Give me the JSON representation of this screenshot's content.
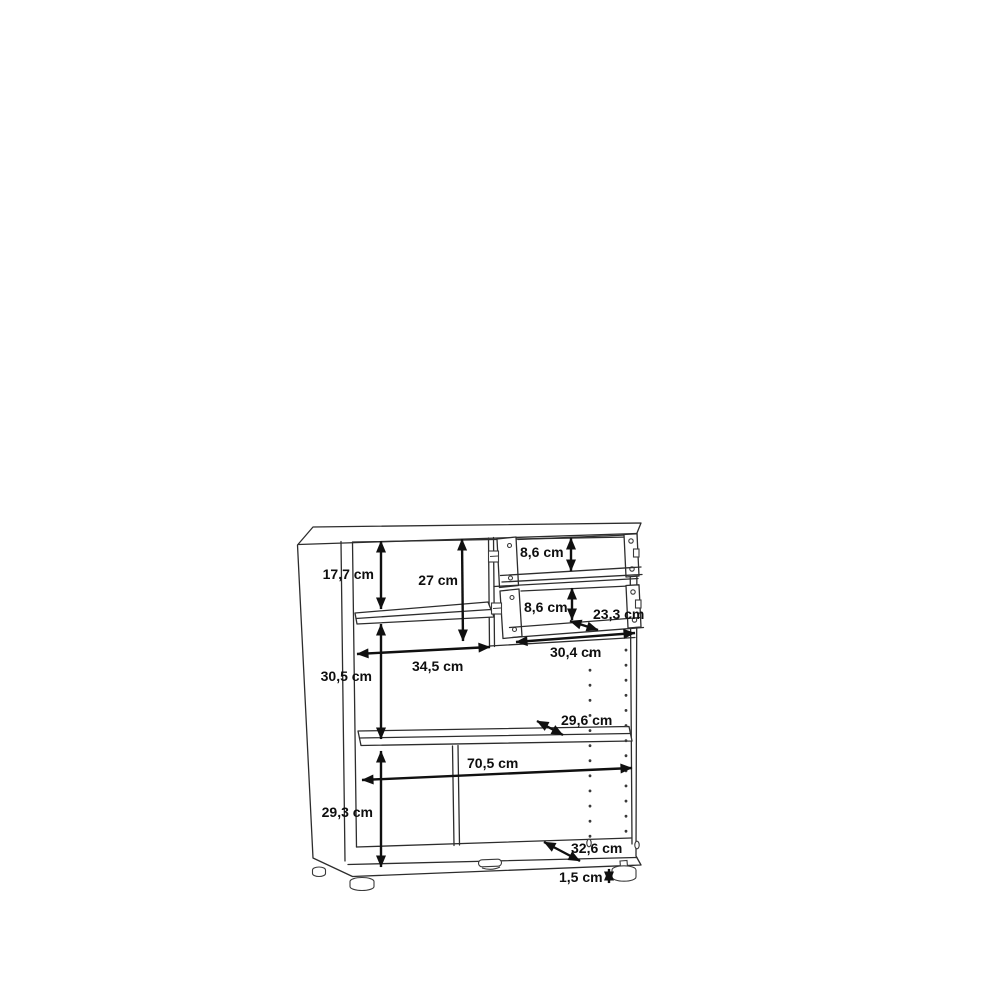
{
  "page": {
    "background_color": "#ffffff"
  },
  "diagram": {
    "kind": "furniture-dimension-drawing",
    "subject": "cabinet with two open drawers, adjustable shelves, shelf-pin holes and feet",
    "unit": "cm",
    "stroke_color": "#2d2d2d",
    "dimension_color": "#0f0f0f",
    "measurements": [
      {
        "id": "upper-left-compartment-height",
        "label": "17,7 cm",
        "value_cm": 17.7,
        "orientation": "vertical"
      },
      {
        "id": "drawer-column-height",
        "label": "27 cm",
        "value_cm": 27,
        "orientation": "vertical"
      },
      {
        "id": "top-drawer-height",
        "label": "8,6 cm",
        "value_cm": 8.6,
        "orientation": "vertical"
      },
      {
        "id": "lower-drawer-height",
        "label": "8,6 cm",
        "value_cm": 8.6,
        "orientation": "vertical"
      },
      {
        "id": "drawer-depth",
        "label": "23,3 cm",
        "value_cm": 23.3,
        "orientation": "diagonal"
      },
      {
        "id": "drawer-width",
        "label": "30,4 cm",
        "value_cm": 30.4,
        "orientation": "horizontal"
      },
      {
        "id": "left-compartment-width",
        "label": "34,5 cm",
        "value_cm": 34.5,
        "orientation": "horizontal"
      },
      {
        "id": "middle-left-height",
        "label": "30,5 cm",
        "value_cm": 30.5,
        "orientation": "vertical"
      },
      {
        "id": "shelf-depth",
        "label": "29,6 cm",
        "value_cm": 29.6,
        "orientation": "diagonal"
      },
      {
        "id": "interior-width",
        "label": "70,5 cm",
        "value_cm": 70.5,
        "orientation": "horizontal"
      },
      {
        "id": "bottom-compartment-height",
        "label": "29,3 cm",
        "value_cm": 29.3,
        "orientation": "vertical"
      },
      {
        "id": "bottom-shelf-depth",
        "label": "32,6 cm",
        "value_cm": 32.6,
        "orientation": "diagonal"
      },
      {
        "id": "foot-height",
        "label": "1,5 cm",
        "value_cm": 1.5,
        "orientation": "vertical"
      }
    ]
  }
}
